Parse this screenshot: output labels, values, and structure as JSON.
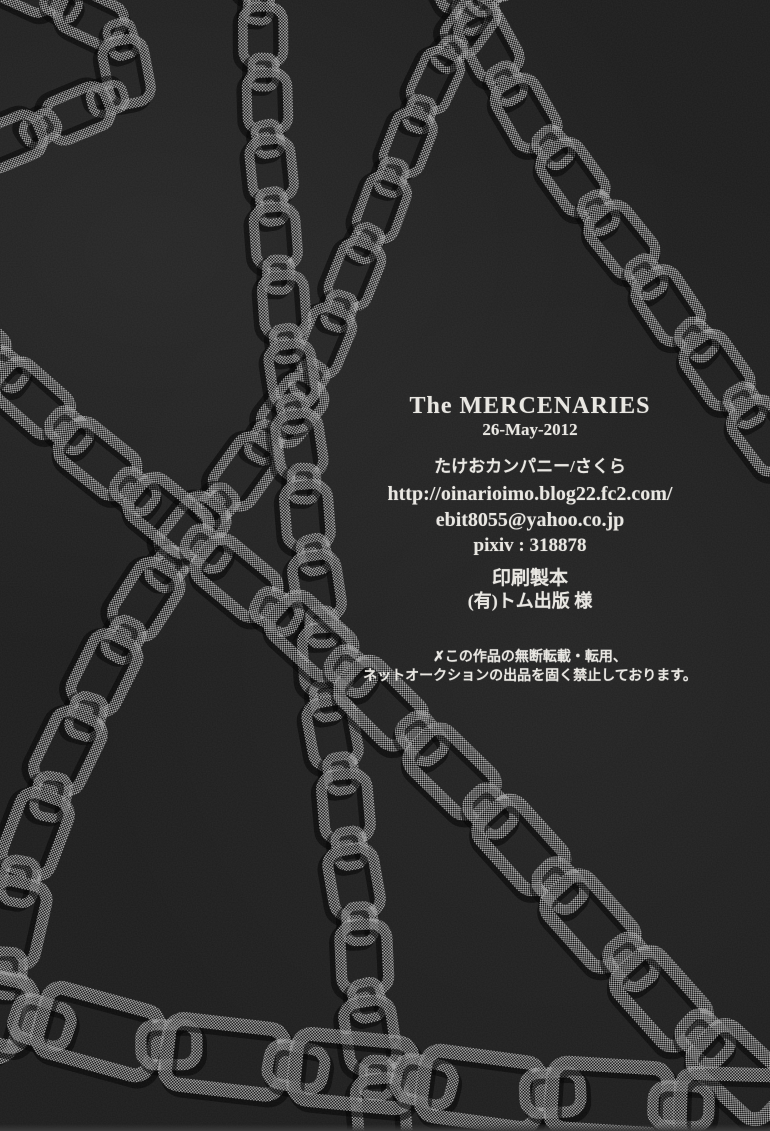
{
  "colors": {
    "background": "#1d1d1d",
    "chain": "#a8a8a8",
    "shadow": "#000000",
    "text": "#eae8e3"
  },
  "artwork": {
    "description": "crisscrossing halftone chains on dark scanned paper"
  },
  "colophon": {
    "title": "The MERCENARIES",
    "date": "26-May-2012",
    "circle": "たけおカンパニー/さくら",
    "url": "http://oinarioimo.blog22.fc2.com/",
    "email": "ebit8055@yahoo.co.jp",
    "pixiv": "pixiv : 318878",
    "printing_heading": "印刷製本",
    "printer": "(有)トム出版 様",
    "warning_line1": "✗この作品の無断転載・転用、",
    "warning_line2": "ネットオークションの出品を固く禁止しております。"
  }
}
